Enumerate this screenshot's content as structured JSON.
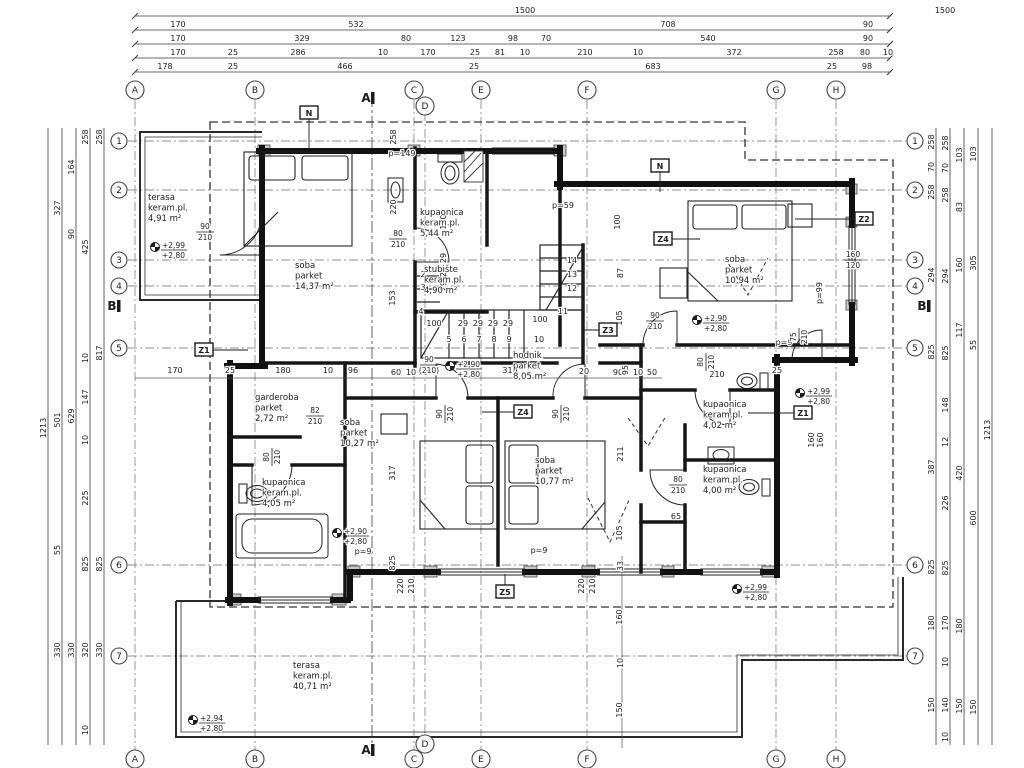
{
  "palette": {
    "paper": "#ffffff",
    "ink": "#1c1c1c",
    "wall": "#111111",
    "dim": "#3a3a3a",
    "grid": "#8d8d8d",
    "pier": "#c9c9c9"
  },
  "grid": {
    "cols": [
      {
        "l": "A",
        "x": 135
      },
      {
        "l": "B",
        "x": 255
      },
      {
        "l": "C",
        "x": 414
      },
      {
        "l": "D",
        "x": 425,
        "dy": 16
      },
      {
        "l": "E",
        "x": 481
      },
      {
        "l": "F",
        "x": 587
      },
      {
        "l": "G",
        "x": 776
      },
      {
        "l": "H",
        "x": 836
      }
    ],
    "rows": [
      {
        "l": "1",
        "y": 141
      },
      {
        "l": "2",
        "y": 190
      },
      {
        "l": "3",
        "y": 260
      },
      {
        "l": "4",
        "y": 286
      },
      {
        "l": "5",
        "y": 348
      },
      {
        "l": "6",
        "y": 565
      },
      {
        "l": "7",
        "y": 656
      }
    ]
  },
  "top_dims": [
    {
      "y": 13,
      "items": [
        {
          "t": "1500",
          "x": 525
        },
        {
          "t": "1500",
          "x": 945
        }
      ]
    },
    {
      "y": 27,
      "items": [
        {
          "t": "170",
          "x": 178
        },
        {
          "t": "532",
          "x": 356
        },
        {
          "t": "708",
          "x": 668
        },
        {
          "t": "90",
          "x": 868
        }
      ]
    },
    {
      "y": 41,
      "items": [
        {
          "t": "170",
          "x": 178
        },
        {
          "t": "329",
          "x": 302
        },
        {
          "t": "80",
          "x": 406
        },
        {
          "t": "123",
          "x": 458
        },
        {
          "t": "98",
          "x": 513
        },
        {
          "t": "70",
          "x": 546
        },
        {
          "t": "540",
          "x": 708
        },
        {
          "t": "90",
          "x": 868
        }
      ]
    },
    {
      "y": 55,
      "items": [
        {
          "t": "170",
          "x": 178
        },
        {
          "t": "25",
          "x": 233
        },
        {
          "t": "286",
          "x": 298
        },
        {
          "t": "10",
          "x": 383
        },
        {
          "t": "170",
          "x": 428
        },
        {
          "t": "25",
          "x": 475
        },
        {
          "t": "81",
          "x": 500
        },
        {
          "t": "10",
          "x": 525
        },
        {
          "t": "210",
          "x": 585
        },
        {
          "t": "10",
          "x": 638
        },
        {
          "t": "372",
          "x": 734
        },
        {
          "t": "258",
          "x": 836
        },
        {
          "t": "80",
          "x": 865
        },
        {
          "t": "10",
          "x": 888
        }
      ]
    },
    {
      "y": 69,
      "items": [
        {
          "t": "178",
          "x": 165
        },
        {
          "t": "25",
          "x": 233
        },
        {
          "t": "466",
          "x": 345
        },
        {
          "t": "25",
          "x": 474
        },
        {
          "t": "683",
          "x": 653
        },
        {
          "t": "25",
          "x": 832
        },
        {
          "t": "98",
          "x": 867
        }
      ]
    }
  ],
  "left_dims": [
    {
      "x": 48,
      "items": [
        {
          "t": "1213",
          "y": 428
        }
      ]
    },
    {
      "x": 62,
      "items": [
        {
          "t": "327",
          "y": 208
        },
        {
          "t": "501",
          "y": 420
        },
        {
          "t": "55",
          "y": 550
        },
        {
          "t": "330",
          "y": 650
        }
      ]
    },
    {
      "x": 76,
      "items": [
        {
          "t": "164",
          "y": 167
        },
        {
          "t": "90",
          "y": 234
        },
        {
          "t": "629",
          "y": 416
        },
        {
          "t": "330",
          "y": 650
        }
      ]
    },
    {
      "x": 90,
      "items": [
        {
          "t": "258",
          "y": 137
        },
        {
          "t": "425",
          "y": 247
        },
        {
          "t": "10",
          "y": 358
        },
        {
          "t": "147",
          "y": 397
        },
        {
          "t": "10",
          "y": 440
        },
        {
          "t": "225",
          "y": 498
        },
        {
          "t": "825",
          "y": 564
        },
        {
          "t": "320",
          "y": 650
        },
        {
          "t": "10",
          "y": 730
        }
      ]
    },
    {
      "x": 104,
      "items": [
        {
          "t": "258",
          "y": 137
        },
        {
          "t": "817",
          "y": 353
        },
        {
          "t": "825",
          "y": 564
        },
        {
          "t": "330",
          "y": 650
        }
      ]
    }
  ],
  "right_dims": [
    {
      "x": 936,
      "items": [
        {
          "t": "258",
          "y": 142
        },
        {
          "t": "70",
          "y": 167
        },
        {
          "t": "258",
          "y": 192
        },
        {
          "t": "294",
          "y": 275
        },
        {
          "t": "825",
          "y": 352
        },
        {
          "t": "387",
          "y": 467
        },
        {
          "t": "825",
          "y": 567
        },
        {
          "t": "180",
          "y": 623
        },
        {
          "t": "150",
          "y": 705
        }
      ]
    },
    {
      "x": 950,
      "items": [
        {
          "t": "258",
          "y": 143
        },
        {
          "t": "70",
          "y": 168
        },
        {
          "t": "258",
          "y": 195
        },
        {
          "t": "294",
          "y": 276
        },
        {
          "t": "825",
          "y": 353
        },
        {
          "t": "148",
          "y": 405
        },
        {
          "t": "12",
          "y": 442
        },
        {
          "t": "226",
          "y": 503
        },
        {
          "t": "825",
          "y": 568
        },
        {
          "t": "170",
          "y": 623
        },
        {
          "t": "10",
          "y": 662
        },
        {
          "t": "140",
          "y": 705
        },
        {
          "t": "10",
          "y": 737
        }
      ]
    },
    {
      "x": 964,
      "items": [
        {
          "t": "103",
          "y": 155
        },
        {
          "t": "83",
          "y": 207
        },
        {
          "t": "160",
          "y": 265
        },
        {
          "t": "117",
          "y": 330
        },
        {
          "t": "420",
          "y": 473
        },
        {
          "t": "180",
          "y": 626
        },
        {
          "t": "150",
          "y": 706
        }
      ]
    },
    {
      "x": 978,
      "items": [
        {
          "t": "103",
          "y": 154
        },
        {
          "t": "305",
          "y": 263
        },
        {
          "t": "55",
          "y": 345
        },
        {
          "t": "600",
          "y": 518
        },
        {
          "t": "150",
          "y": 707
        }
      ]
    },
    {
      "x": 992,
      "items": [
        {
          "t": "1213",
          "y": 430
        }
      ]
    }
  ],
  "plan_dims": [
    {
      "x": 396,
      "y": 137,
      "t": "258",
      "r": 1
    },
    {
      "x": 396,
      "y": 207,
      "t": "220",
      "r": 1
    },
    {
      "x": 395,
      "y": 298,
      "t": "153",
      "r": 1
    },
    {
      "x": 446,
      "y": 222,
      "t": "100",
      "r": 1
    },
    {
      "x": 446,
      "y": 258,
      "t": "29",
      "r": 1
    },
    {
      "x": 446,
      "y": 272,
      "t": "29",
      "r": 1
    },
    {
      "x": 446,
      "y": 286,
      "t": "29",
      "r": 1
    },
    {
      "x": 620,
      "y": 222,
      "t": "100",
      "r": 1
    },
    {
      "x": 623,
      "y": 273,
      "t": "87",
      "r": 1
    },
    {
      "x": 622,
      "y": 318,
      "t": "105",
      "r": 1
    },
    {
      "x": 434,
      "y": 326,
      "t": "100"
    },
    {
      "x": 463,
      "y": 326,
      "t": "29"
    },
    {
      "x": 478,
      "y": 326,
      "t": "29"
    },
    {
      "x": 493,
      "y": 326,
      "t": "29"
    },
    {
      "x": 508,
      "y": 326,
      "t": "29"
    },
    {
      "x": 540,
      "y": 322,
      "t": "100"
    },
    {
      "x": 423,
      "y": 277,
      "t": "2"
    },
    {
      "x": 423,
      "y": 290,
      "t": "3"
    },
    {
      "x": 421,
      "y": 314,
      "t": "4"
    },
    {
      "x": 449,
      "y": 342,
      "t": "5"
    },
    {
      "x": 464,
      "y": 342,
      "t": "6"
    },
    {
      "x": 479,
      "y": 342,
      "t": "7"
    },
    {
      "x": 494,
      "y": 342,
      "t": "8"
    },
    {
      "x": 509,
      "y": 342,
      "t": "9"
    },
    {
      "x": 539,
      "y": 342,
      "t": "10"
    },
    {
      "x": 563,
      "y": 314,
      "t": "11"
    },
    {
      "x": 572,
      "y": 291,
      "t": "12"
    },
    {
      "x": 572,
      "y": 277,
      "t": "13"
    },
    {
      "x": 572,
      "y": 263,
      "t": "14"
    },
    {
      "x": 402,
      "y": 156,
      "t": "p=149"
    },
    {
      "x": 563,
      "y": 208,
      "t": "p=59"
    },
    {
      "x": 822,
      "y": 293,
      "t": "p=99",
      "r": 1
    },
    {
      "x": 784,
      "y": 345,
      "t": "p=9"
    },
    {
      "x": 539,
      "y": 553,
      "t": "p=9"
    },
    {
      "x": 363,
      "y": 554,
      "t": "p=9"
    },
    {
      "x": 175,
      "y": 373,
      "t": "170"
    },
    {
      "x": 230,
      "y": 373,
      "t": "25"
    },
    {
      "x": 283,
      "y": 373,
      "t": "180"
    },
    {
      "x": 328,
      "y": 373,
      "t": "10"
    },
    {
      "x": 353,
      "y": 373,
      "t": "96"
    },
    {
      "x": 396,
      "y": 375,
      "t": "60"
    },
    {
      "x": 411,
      "y": 375,
      "t": "10"
    },
    {
      "x": 423,
      "y": 375,
      "t": "10"
    },
    {
      "x": 510,
      "y": 373,
      "t": "316"
    },
    {
      "x": 584,
      "y": 374,
      "t": "20"
    },
    {
      "x": 618,
      "y": 375,
      "t": "90"
    },
    {
      "x": 628,
      "y": 370,
      "t": "95",
      "r": 1
    },
    {
      "x": 638,
      "y": 375,
      "t": "10"
    },
    {
      "x": 652,
      "y": 375,
      "t": "50"
    },
    {
      "x": 777,
      "y": 373,
      "t": "25"
    },
    {
      "x": 717,
      "y": 377,
      "t": "210"
    },
    {
      "x": 395,
      "y": 473,
      "t": "317",
      "r": 1
    },
    {
      "x": 623,
      "y": 454,
      "t": "211",
      "r": 1
    },
    {
      "x": 622,
      "y": 533,
      "t": "105",
      "r": 1
    },
    {
      "x": 676,
      "y": 519,
      "t": "65"
    },
    {
      "x": 395,
      "y": 563,
      "t": "825",
      "r": 1
    },
    {
      "x": 403,
      "y": 586,
      "t": "220",
      "r": 1
    },
    {
      "x": 414,
      "y": 586,
      "t": "210",
      "r": 1
    },
    {
      "x": 584,
      "y": 586,
      "t": "220",
      "r": 1
    },
    {
      "x": 595,
      "y": 586,
      "t": "210",
      "r": 1
    },
    {
      "x": 623,
      "y": 566,
      "t": "33",
      "r": 1
    },
    {
      "x": 622,
      "y": 617,
      "t": "160",
      "r": 1
    },
    {
      "x": 623,
      "y": 663,
      "t": "10",
      "r": 1
    },
    {
      "x": 622,
      "y": 710,
      "t": "150",
      "r": 1
    },
    {
      "x": 814,
      "y": 440,
      "t": "160",
      "r": 1
    },
    {
      "x": 823,
      "y": 440,
      "t": "160",
      "r": 1
    }
  ],
  "door_labels": [
    {
      "x": 205,
      "y": 231,
      "a": "90",
      "b": "210"
    },
    {
      "x": 398,
      "y": 238,
      "a": "80",
      "b": "210"
    },
    {
      "x": 655,
      "y": 320,
      "a": "90",
      "b": "210"
    },
    {
      "x": 444,
      "y": 414,
      "a": "90",
      "b": "210",
      "r": 1
    },
    {
      "x": 560,
      "y": 414,
      "a": "90",
      "b": "210",
      "r": 1
    },
    {
      "x": 315,
      "y": 415,
      "a": "82",
      "b": "210"
    },
    {
      "x": 271,
      "y": 457,
      "a": "80",
      "b": "210",
      "r": 1
    },
    {
      "x": 705,
      "y": 362,
      "a": "80",
      "b": "210",
      "r": 1
    },
    {
      "x": 678,
      "y": 484,
      "a": "80",
      "b": "210"
    },
    {
      "x": 798,
      "y": 337,
      "a": "75",
      "b": "210",
      "r": 1
    },
    {
      "x": 429,
      "y": 364,
      "a": "90",
      "b": "(210)"
    },
    {
      "x": 853,
      "y": 259,
      "a": "160",
      "b": "120"
    }
  ],
  "rooms": [
    {
      "x": 148,
      "y": 200,
      "lines": [
        "terasa",
        "keram.pl.",
        "4,91 m²"
      ]
    },
    {
      "x": 295,
      "y": 268,
      "lines": [
        "soba",
        "parket",
        "14,37 m²"
      ]
    },
    {
      "x": 420,
      "y": 215,
      "lines": [
        "kupaonica",
        "keram.pl.",
        "5,44 m²"
      ]
    },
    {
      "x": 424,
      "y": 272,
      "lines": [
        "stubište",
        "keram.pl.",
        "4,90 m²"
      ]
    },
    {
      "x": 725,
      "y": 262,
      "lines": [
        "soba",
        "parket",
        "10,94 m²"
      ]
    },
    {
      "x": 513,
      "y": 358,
      "lines": [
        "hodnik",
        "parket",
        "8,05 m²"
      ]
    },
    {
      "x": 255,
      "y": 400,
      "lines": [
        "garderoba",
        "parket",
        "2,72 m²"
      ]
    },
    {
      "x": 340,
      "y": 425,
      "lines": [
        "soba",
        "parket",
        "10,27 m²"
      ]
    },
    {
      "x": 535,
      "y": 463,
      "lines": [
        "soba",
        "parket",
        "10,77 m²"
      ]
    },
    {
      "x": 262,
      "y": 485,
      "lines": [
        "kupaonica",
        "keram.pl.",
        "4,05 m²"
      ]
    },
    {
      "x": 703,
      "y": 407,
      "lines": [
        "kupaonica",
        "keram.pl.",
        "4,02 m²"
      ]
    },
    {
      "x": 703,
      "y": 472,
      "lines": [
        "kupaonica",
        "keram.pl.",
        "4,00 m²"
      ]
    },
    {
      "x": 293,
      "y": 668,
      "lines": [
        "terasa",
        "keram.pl.",
        "40,71 m²"
      ]
    }
  ],
  "levels": [
    {
      "x": 155,
      "y": 247,
      "a": "+2,99",
      "b": "+2,80"
    },
    {
      "x": 450,
      "y": 366,
      "a": "+2,90",
      "b": "+2,80"
    },
    {
      "x": 697,
      "y": 320,
      "a": "+2,90",
      "b": "+2,80"
    },
    {
      "x": 800,
      "y": 393,
      "a": "+2,99",
      "b": "+2,80"
    },
    {
      "x": 337,
      "y": 533,
      "a": "+2,90",
      "b": "+2,80"
    },
    {
      "x": 737,
      "y": 589,
      "a": "+2,99",
      "b": "+2,80"
    },
    {
      "x": 193,
      "y": 720,
      "a": "+2,94",
      "b": "+2,80"
    }
  ],
  "markers": [
    {
      "x": 309,
      "y": 113,
      "t": "N",
      "lx": 309,
      "ly": 150
    },
    {
      "x": 660,
      "y": 166,
      "t": "N",
      "lx": 660,
      "ly": 192
    },
    {
      "x": 204,
      "y": 350,
      "t": "Z1",
      "lx": 248,
      "ly": 350
    },
    {
      "x": 803,
      "y": 413,
      "t": "Z1",
      "lx": 748,
      "ly": 413
    },
    {
      "x": 864,
      "y": 219,
      "t": "Z2",
      "lx": 795,
      "ly": 219
    },
    {
      "x": 608,
      "y": 330,
      "t": "Z3",
      "lx": 583,
      "ly": 330
    },
    {
      "x": 663,
      "y": 239,
      "t": "Z4",
      "lx": 700,
      "ly": 239
    },
    {
      "x": 523,
      "y": 412,
      "t": "Z4",
      "lx": 482,
      "ly": 412
    },
    {
      "x": 505,
      "y": 592,
      "t": "Z5",
      "lx": 505,
      "ly": 574
    }
  ],
  "sections": [
    {
      "t": "A",
      "x": 366,
      "y": 102
    },
    {
      "t": "A",
      "x": 366,
      "y": 754
    },
    {
      "t": "B",
      "x": 112,
      "y": 310
    },
    {
      "t": "B",
      "x": 922,
      "y": 310
    }
  ]
}
